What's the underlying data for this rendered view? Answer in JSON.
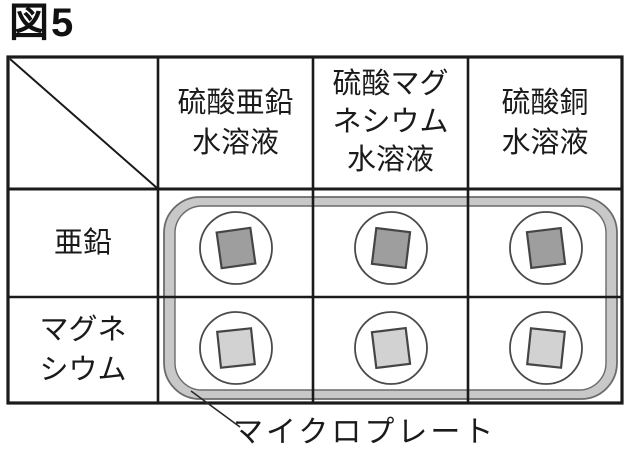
{
  "figure": {
    "title": "図5"
  },
  "table": {
    "column_headers": [
      "硫酸亜鉛\n水溶液",
      "硫酸マグ\nネシウム\n水溶液",
      "硫酸銅\n水溶液"
    ],
    "row_headers": [
      "亜鉛",
      "マグネ\nシウム"
    ]
  },
  "microplate": {
    "label": "マイクロプレート",
    "rim_color": "#c8c8c8",
    "well_fill": "#ffffff",
    "rows": 2,
    "cols": 3,
    "metal_chips": [
      {
        "metal": "亜鉛",
        "color": "#9e9e9e"
      },
      {
        "metal": "マグネシウム",
        "color": "#d2d2d2"
      }
    ]
  },
  "colors": {
    "grid_line": "#1a1a1a",
    "plate_outline": "#6b6b6b",
    "chip_outline": "#454545",
    "background": "#ffffff"
  }
}
